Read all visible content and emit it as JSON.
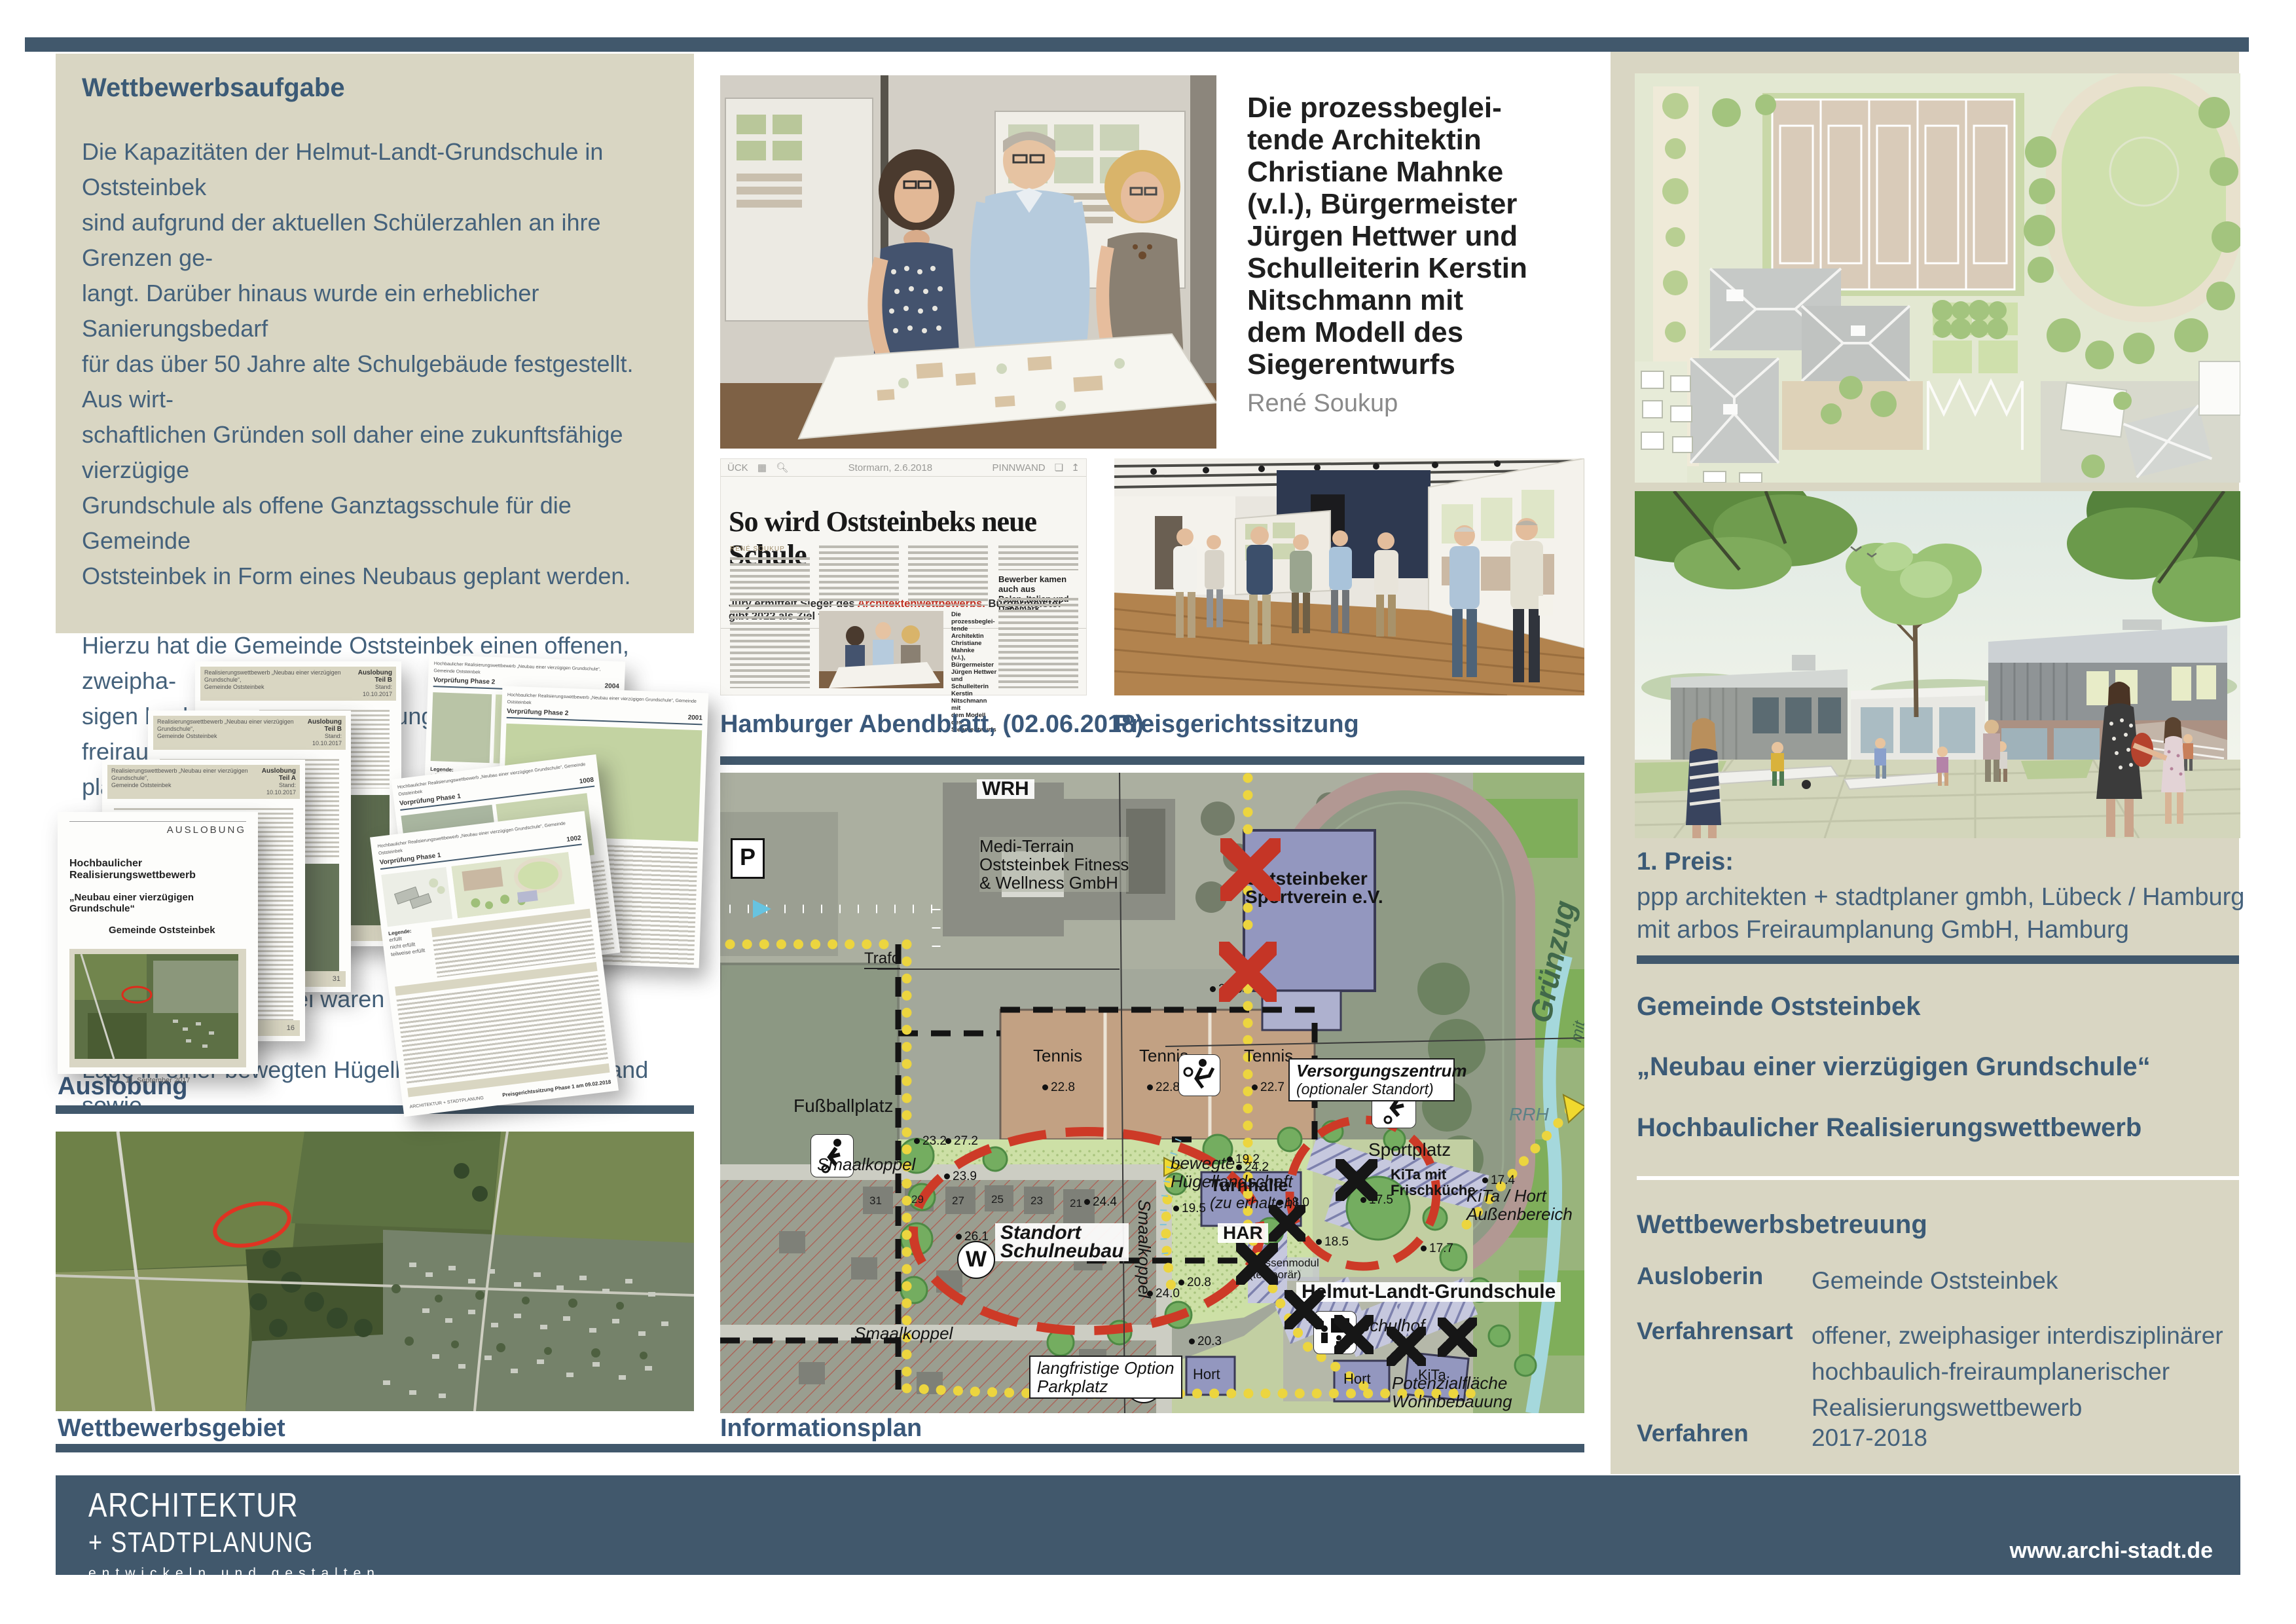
{
  "task": {
    "title": "Wettbewerbsaufgabe",
    "paragraph1": "Die Kapazitäten der Helmut-Landt-Grundschule in Oststeinbek\nsind aufgrund der aktuellen Schülerzahlen an ihre Grenzen ge-\nlangt. Darüber hinaus wurde ein erheblicher Sanierungsbedarf\nfür das über 50 Jahre alte Schulgebäude festgestellt. Aus wirt-\nschaftlichen Gründen soll daher eine zukunftsfähige vierzügige\nGrundschule als offene Ganztagsschule für die Gemeinde\nOststeinbek in Form eines Neubaus geplant werden.",
    "paragraph2": "Hierzu hat die Gemeinde Oststeinbek einen offenen, zweipha-\nsigen hochbaulichen Realisierungswettbewerb mit freiraum-\nplanerischem Anteil ausgelobt. Ziel des Wettbewerbs war die\nErlangung von qualitätsvollen Ideen und Entwürfen für den\nNeubau der Grundschule im Norden der Ortslage der Gemein-\nde Oststeinbek. Dabei waren die besondere landschaftliche\nLage in einer bewegten Hügellandschaft am Waldrand sowie\ndie unterschiedlichen Anforderungen an den Freiraum\n(Erschließung, Aufenthaltsqualitäten etc.) zu beachten."
  },
  "model_photo_caption": {
    "lines": "Die prozessbeglei-\ntende Architektin\nChristiane Mahnke\n(v.l.), Bürgermeister\nJürgen Hettwer und\nSchulleiterin Kerstin\nNitschmann mit\ndem Modell des\nSiegerentwurfs",
    "credit": "René Soukup"
  },
  "newspaper": {
    "masthead_left": "ÜCK",
    "masthead_date": "Stormarn, 2.6.2018",
    "masthead_right": "PINNWAND",
    "headline": "So wird Oststeinbeks neue Schule",
    "subhead_pre": "Jury ermittelt Sieger des ",
    "subhead_red": "Architektenwettbewerbs.",
    "subhead_post": " Bürgermeister gibt 2022 als Ziel für den Einzug aus",
    "byline": "RENÉ SOUKUP",
    "column_heading": "Bewerber kamen auch aus\nPolen, Italien und Dänemark",
    "photo_caption": "Die prozessbeglei-\ntende Architektin\nChristiane Mahnke\n(v.l.), Bürgermeister\nJürgen Hettwer und\nSchulleiterin Kerstin\nNitschmann mit\ndem Modell des\nSiegerentwurfs",
    "photo_credit": "René Soukup"
  },
  "captions": {
    "auslobung": "Auslobung",
    "vorpruefung": "Vorprüfung",
    "wettbewerbsgebiet": "Wettbewerbsgebiet",
    "hamburger_abendblatt": "Hamburger Abendblatt, (02.06.2018)",
    "preisgerichtssitzung": "Preisgerichtssitzung",
    "informationsplan": "Informationsplan"
  },
  "auslobung_doc": {
    "header_small": "Realisierungswettbewerb „Neubau einer vierzügigen Grundschule“,\nGemeinde Oststeinbek",
    "teil_a": "Auslobung Teil A",
    "teil_b": "Auslobung Teil B",
    "stand": "Stand: 10.10.2017",
    "cover_tag": "AUSLOBUNG",
    "cover_line1": "Hochbaulicher Realisierungswettbewerb",
    "cover_line2": "„Neubau einer vierzügigen Grundschule“",
    "cover_line3": "Gemeinde Oststeinbek",
    "cover_date": "11. September 2017",
    "page_16": "16",
    "page_31": "31",
    "page_34": "34"
  },
  "vorpruefung_doc": {
    "header_small": "Hochbaulicher Realisierungswettbewerb „Neubau einer vierzügigen Grundschule“, Gemeinde Oststeinbek",
    "phase1": "Vorprüfung Phase 1",
    "phase2": "Vorprüfung Phase 2",
    "num_2004": "2004",
    "num_2001": "2001",
    "num_1008": "1008",
    "num_1002": "1002",
    "legend_title": "Legende:",
    "legend_1": "erfüllt",
    "legend_2": "nicht erfüllt",
    "legend_3": "teilweise erfüllt",
    "page_footer_left": "ARCHITEKTUR + STADTPLANUNG",
    "footer": "Preisgerichtssitzung Phase 1 am 09.02.2018"
  },
  "map": {
    "wrh": "WRH",
    "medi_terrain": "Medi-Terrain\nOststeinbek Fitness\n& Wellness GmbH",
    "sportverein": "Oststeinbeker\nSportverein e.V.",
    "trafo": "Trafo",
    "tennis": "Tennis",
    "fussballplatz": "Fußballplatz",
    "sportplatz": "Sportplatz",
    "versorgung_bold": "Versorgungszentrum",
    "versorgung_italic": "(optionaler Standort)",
    "standort": "Standort\nSchulneubau",
    "huegel": "bewegte\nHügellandschaft",
    "smaalkoppel": "Smaalkoppel",
    "langfristig": "langfristige Option\nParkplatz",
    "turnhalle_bold": "Turnhalle",
    "turnhalle_italic": "(zu erhalten)",
    "har": "HAR",
    "klassenmodul": "Klassenmodul\n(temporär)",
    "grundschule": "Helmut-Landt-Grundschule",
    "schulhof": "Schulhof",
    "kita_frisch": "KiTa mit\nFrischküche",
    "kita_hort_aussen": "KiTa / Hort\nAußenbereich",
    "hort": "Hort",
    "kita": "KiTa",
    "potenzial": "Potenzialfläche\nWohnbebauung",
    "gruenzug": "Grünzug",
    "gruenzug_sub": "mit Fuß- und Radweg",
    "rrh": "RRH",
    "w_label": "W",
    "p_label": "P",
    "houses": [
      "31",
      "29",
      "27",
      "25",
      "23",
      "21"
    ],
    "elev": {
      "e1": "22.8",
      "e2": "22.8",
      "e3": "22.7",
      "e4": "23.2",
      "e5": "24.4",
      "e6": "24.2",
      "e7": "26.1",
      "e8": "24.0",
      "e9": "21.0",
      "e10": "19.5",
      "e11": "20.8",
      "e12": "20.3",
      "e13": "18.5",
      "e14": "17.7",
      "e15": "17.4",
      "e16": "18.0",
      "e17": "17.5",
      "e18": "23.9",
      "e19": "19.2",
      "e20": "27.2"
    }
  },
  "prize": {
    "heading": "1. Preis:",
    "line1": "ppp architekten + stadtplaner gmbh, Lübeck / Hamburg",
    "line2": "mit arbos Freiraumplanung GmbH, Hamburg"
  },
  "project": {
    "client": "Gemeinde Oststeinbek",
    "title": "„Neubau einer vierzügigen Grundschule“",
    "subtitle": "Hochbaulicher Realisierungswettbewerb"
  },
  "details": {
    "heading": "Wettbewerbsbetreuung",
    "rows": [
      {
        "label": "Ausloberin",
        "value": "Gemeinde Oststeinbek"
      },
      {
        "label": "Verfahrensart",
        "value": "offener, zweiphasiger interdisziplinärer\nhochbaulich-freiraumplanerischer\nRealisierungswettbewerb"
      },
      {
        "label": "Verfahren",
        "value": "2017-2018"
      }
    ]
  },
  "footer": {
    "logo_line1": "ARCHITEKTUR",
    "logo_line2": "+ STADTPLANUNG",
    "logo_line3": "entwickeln und gestalten",
    "website": "www.archi-stadt.de"
  },
  "colors": {
    "accent": "#41586c",
    "beige": "#d9d6c3",
    "text": "#44617b",
    "red_mark": "#c53526",
    "purple_building": "#9397bf"
  }
}
